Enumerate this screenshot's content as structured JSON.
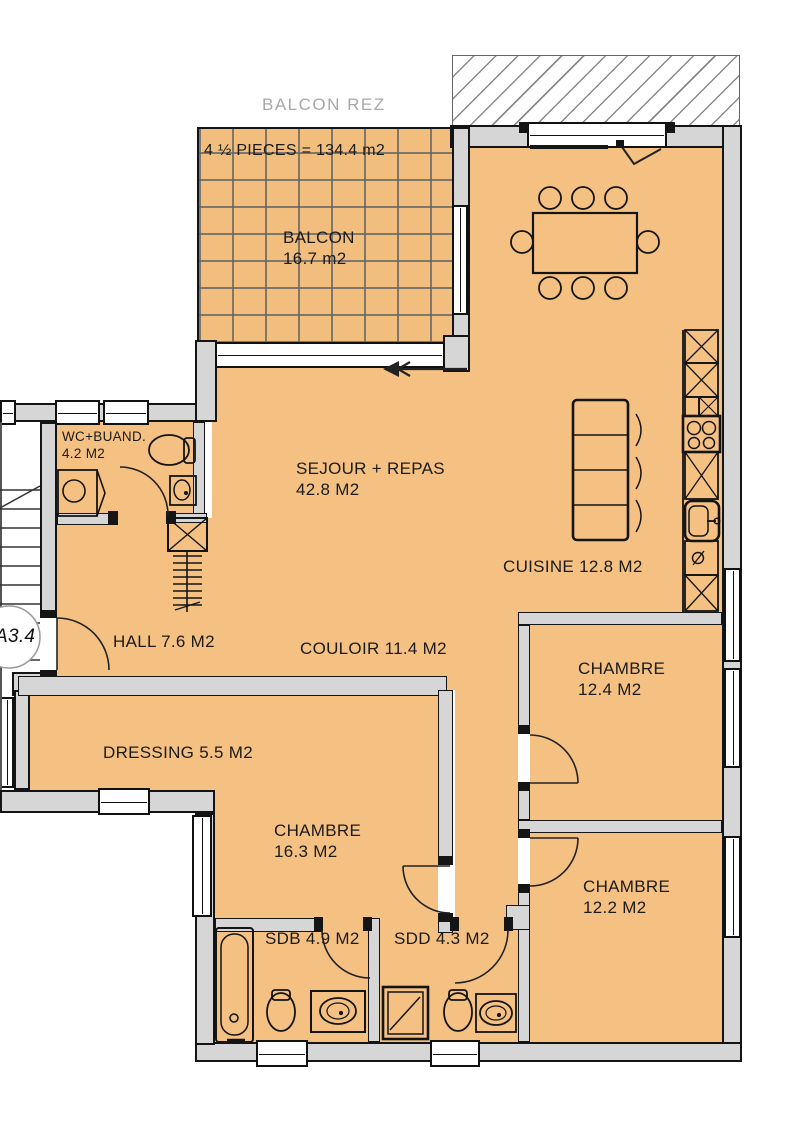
{
  "labels": {
    "balcon_rez": "BALCON REZ",
    "unit_size": "4 ½ PIECES = 134.4 m2",
    "unit_ref": "A3.4"
  },
  "rooms": {
    "balcon": {
      "name": "BALCON",
      "area": "16.7 m2"
    },
    "sejour": {
      "name": "SEJOUR + REPAS",
      "area": "42.8 M2"
    },
    "cuisine": {
      "name": "CUISINE 12.8 M2"
    },
    "wc_buand": {
      "name": "WC+BUAND.",
      "area": "4.2 M2"
    },
    "hall": {
      "name": "HALL 7.6 M2"
    },
    "couloir": {
      "name": "COULOIR 11.4 M2"
    },
    "chambre_est": {
      "name": "CHAMBRE",
      "area": "12.4 M2"
    },
    "dressing": {
      "name": "DRESSING 5.5 M2"
    },
    "chambre_ouest": {
      "name": "CHAMBRE",
      "area": "16.3 M2"
    },
    "sdb": {
      "name": "SDB 4.9 M2"
    },
    "sdd": {
      "name": "SDD 4.3 M2"
    },
    "chambre_sud": {
      "name": "CHAMBRE",
      "area": "12.2 M2"
    }
  },
  "colors": {
    "floor": "#F5C183",
    "balcony_floor": "#F2BE7E",
    "wall": "#D6D6D6",
    "outline": "#141414",
    "muted_text": "#A8A8A8",
    "label_text": "#1B1B1B"
  }
}
